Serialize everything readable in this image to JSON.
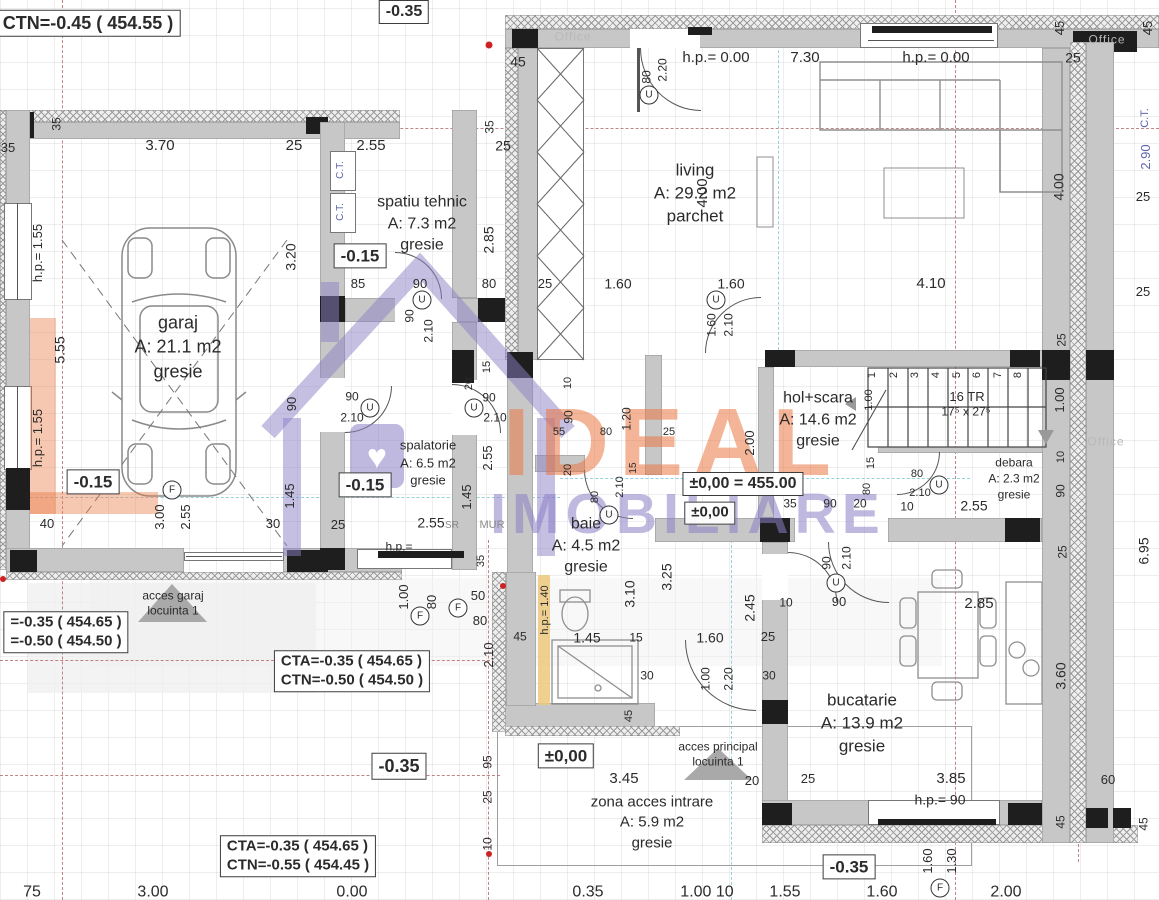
{
  "watermark": {
    "brand_top": "IDEAL",
    "brand_bottom": "IMOBILIARE",
    "office": "Office"
  },
  "colors": {
    "wall_gray": "#c7c7c7",
    "wall_dark": "#1e1e1e",
    "axis_red": "#b06868",
    "cyan": "#7ec4d4",
    "yellow": "#ecc87e",
    "blue_label": "#5f63ae",
    "brand_orange": "#ea7642",
    "brand_purple": "#8b80c6"
  },
  "levels": [
    {
      "lines": [
        "CTN=-0.45 ( 454.55 )"
      ],
      "x": 88,
      "y": 23,
      "s": 18
    },
    {
      "lines": [
        "-0.35"
      ],
      "x": 404,
      "y": 12,
      "s": 16
    },
    {
      "lines": [
        "-0.15"
      ],
      "x": 360,
      "y": 256,
      "s": 17
    },
    {
      "lines": [
        "-0.15"
      ],
      "x": 93,
      "y": 482,
      "s": 17
    },
    {
      "lines": [
        "-0.15"
      ],
      "x": 365,
      "y": 485,
      "s": 17
    },
    {
      "lines": [
        "±0,00 = 455.00"
      ],
      "x": 743,
      "y": 484,
      "s": 16
    },
    {
      "lines": [
        "±0,00"
      ],
      "x": 710,
      "y": 513,
      "s": 15
    },
    {
      "lines": [
        "±0,00"
      ],
      "x": 566,
      "y": 756,
      "s": 17
    },
    {
      "lines": [
        "-0.35"
      ],
      "x": 399,
      "y": 766,
      "s": 18
    },
    {
      "lines": [
        "-0.35"
      ],
      "x": 849,
      "y": 867,
      "s": 17
    },
    {
      "lines": [
        "=-0.35 ( 454.65 )",
        "=-0.50 ( 454.50 )"
      ],
      "x": 66,
      "y": 632,
      "s": 15
    },
    {
      "lines": [
        "CTA=-0.35 ( 454.65 )",
        "CTN=-0.50 ( 454.50 )"
      ],
      "x": 352,
      "y": 671,
      "s": 15
    },
    {
      "lines": [
        "CTA=-0.35 ( 454.65 )",
        "CTN=-0.55 ( 454.45 )"
      ],
      "x": 298,
      "y": 856,
      "s": 15
    }
  ],
  "rooms": [
    {
      "lines": [
        "garaj",
        "A: 21.1 m2",
        "gresie"
      ],
      "x": 178,
      "y": 347,
      "s": 18
    },
    {
      "lines": [
        "spatiu tehnic",
        "A: 7.3 m2",
        "gresie"
      ],
      "x": 422,
      "y": 224,
      "s": 16
    },
    {
      "lines": [
        "living",
        "A: 29.2 m2",
        "parchet"
      ],
      "x": 695,
      "y": 194,
      "s": 17
    },
    {
      "lines": [
        "spalatorie",
        "A: 6.5 m2",
        "gresie"
      ],
      "x": 428,
      "y": 463,
      "s": 13
    },
    {
      "lines": [
        "hol+scara",
        "A: 14.6 m2",
        "gresie"
      ],
      "x": 818,
      "y": 420,
      "s": 16
    },
    {
      "lines": [
        "debara",
        "A: 2.3 m2",
        "gresie"
      ],
      "x": 1014,
      "y": 479,
      "s": 12
    },
    {
      "lines": [
        "baie",
        "A: 4.5 m2",
        "gresie"
      ],
      "x": 586,
      "y": 546,
      "s": 16
    },
    {
      "lines": [
        "bucatarie",
        "A: 13.9 m2",
        "gresie"
      ],
      "x": 862,
      "y": 724,
      "s": 17
    },
    {
      "lines": [
        "zona acces intrare",
        "A: 5.9 m2",
        "gresie"
      ],
      "x": 652,
      "y": 823,
      "s": 15
    }
  ],
  "labels": [
    {
      "t": "35",
      "x": 8,
      "y": 148,
      "s": 13
    },
    {
      "t": "3.70",
      "x": 160,
      "y": 146,
      "s": 15
    },
    {
      "t": "25",
      "x": 294,
      "y": 146,
      "s": 15
    },
    {
      "t": "2.55",
      "x": 371,
      "y": 146,
      "s": 15
    },
    {
      "t": "25",
      "x": 503,
      "y": 146,
      "s": 14
    },
    {
      "t": "35",
      "x": 57,
      "y": 124,
      "r": 1,
      "s": 12
    },
    {
      "t": "35",
      "x": 490,
      "y": 127,
      "r": 1,
      "s": 12
    },
    {
      "t": "45",
      "x": 518,
      "y": 62,
      "s": 14
    },
    {
      "t": "80",
      "x": 647,
      "y": 77,
      "r": 1,
      "s": 12
    },
    {
      "t": "2.20",
      "x": 663,
      "y": 70,
      "r": 1,
      "s": 12
    },
    {
      "t": "h.p.= 0.00",
      "x": 716,
      "y": 58,
      "s": 15
    },
    {
      "t": "7.30",
      "x": 805,
      "y": 58,
      "s": 15
    },
    {
      "t": "h.p.= 0.00",
      "x": 936,
      "y": 58,
      "s": 15
    },
    {
      "t": "25",
      "x": 1073,
      "y": 58,
      "s": 14
    },
    {
      "t": "45",
      "x": 1060,
      "y": 28,
      "r": 1,
      "s": 13
    },
    {
      "t": "45",
      "x": 1148,
      "y": 28,
      "r": 1,
      "s": 13
    },
    {
      "t": "C.T.",
      "x": 1146,
      "y": 118,
      "r": 1,
      "c": "blue",
      "s": 11
    },
    {
      "t": "2.90",
      "x": 1146,
      "y": 157,
      "r": 1,
      "c": "blue",
      "s": 13
    },
    {
      "t": "25",
      "x": 1143,
      "y": 197,
      "s": 13
    },
    {
      "t": "4.00",
      "x": 1059,
      "y": 187,
      "r": 1,
      "s": 14
    },
    {
      "t": "25",
      "x": 1143,
      "y": 292,
      "s": 13
    },
    {
      "t": "4.00",
      "x": 703,
      "y": 193,
      "r": 1,
      "s": 15
    },
    {
      "t": "2.85",
      "x": 489,
      "y": 240,
      "r": 1,
      "s": 14
    },
    {
      "t": "3.20",
      "x": 291,
      "y": 257,
      "r": 1,
      "s": 14
    },
    {
      "t": "C.T.",
      "x": 341,
      "y": 170,
      "r": 1,
      "c": "blue",
      "s": 10
    },
    {
      "t": "C.T.",
      "x": 341,
      "y": 212,
      "r": 1,
      "c": "blue",
      "s": 10
    },
    {
      "t": "85",
      "x": 358,
      "y": 284,
      "s": 13
    },
    {
      "t": "90",
      "x": 420,
      "y": 284,
      "s": 13
    },
    {
      "t": "80",
      "x": 489,
      "y": 284,
      "s": 13
    },
    {
      "t": "25",
      "x": 545,
      "y": 284,
      "s": 13
    },
    {
      "t": "1.60",
      "x": 618,
      "y": 284,
      "s": 14
    },
    {
      "t": "1.60",
      "x": 731,
      "y": 284,
      "s": 14
    },
    {
      "t": "4.10",
      "x": 931,
      "y": 284,
      "s": 15
    },
    {
      "t": "90",
      "x": 410,
      "y": 316,
      "r": 1,
      "s": 12
    },
    {
      "t": "2.10",
      "x": 429,
      "y": 331,
      "r": 1,
      "s": 12
    },
    {
      "t": "h.p.= 1.55",
      "x": 38,
      "y": 253,
      "r": 1,
      "s": 13
    },
    {
      "t": "5.55",
      "x": 60,
      "y": 350,
      "r": 1,
      "s": 14
    },
    {
      "t": "h.p.= 1.55",
      "x": 38,
      "y": 438,
      "r": 1,
      "s": 13
    },
    {
      "t": "90",
      "x": 292,
      "y": 404,
      "r": 1,
      "s": 13
    },
    {
      "t": "1.45",
      "x": 290,
      "y": 496,
      "r": 1,
      "s": 13
    },
    {
      "t": "90",
      "x": 352,
      "y": 397,
      "s": 12
    },
    {
      "t": "2.10",
      "x": 352,
      "y": 418,
      "s": 12
    },
    {
      "t": "90",
      "x": 489,
      "y": 398,
      "s": 12
    },
    {
      "t": "2.10",
      "x": 495,
      "y": 418,
      "s": 12
    },
    {
      "t": "20",
      "x": 470,
      "y": 384,
      "r": 1,
      "s": 11
    },
    {
      "t": "15",
      "x": 488,
      "y": 367,
      "r": 1,
      "s": 11
    },
    {
      "t": "2.55",
      "x": 488,
      "y": 458,
      "r": 1,
      "s": 13
    },
    {
      "t": "1.45",
      "x": 467,
      "y": 497,
      "r": 1,
      "s": 13
    },
    {
      "t": "40",
      "x": 47,
      "y": 524,
      "s": 13
    },
    {
      "t": "3.00",
      "x": 160,
      "y": 517,
      "r": 1,
      "s": 13
    },
    {
      "t": "2.55",
      "x": 186,
      "y": 517,
      "r": 1,
      "s": 13
    },
    {
      "t": "30",
      "x": 273,
      "y": 524,
      "s": 13
    },
    {
      "t": "25",
      "x": 338,
      "y": 525,
      "s": 13
    },
    {
      "t": "2.55",
      "x": 431,
      "y": 523,
      "s": 14
    },
    {
      "t": "SR",
      "x": 452,
      "y": 526,
      "s": 10,
      "c": "gray"
    },
    {
      "t": "MUR",
      "x": 492,
      "y": 526,
      "s": 11,
      "c": "gray"
    },
    {
      "t": "h.p.=",
      "x": 399,
      "y": 547,
      "s": 12
    },
    {
      "t": "10",
      "x": 569,
      "y": 383,
      "r": 1,
      "s": 11
    },
    {
      "t": "90",
      "x": 569,
      "y": 417,
      "r": 1,
      "s": 12
    },
    {
      "t": "55",
      "x": 559,
      "y": 433,
      "s": 11
    },
    {
      "t": "80",
      "x": 606,
      "y": 433,
      "s": 11
    },
    {
      "t": "1.20",
      "x": 627,
      "y": 419,
      "r": 1,
      "s": 12
    },
    {
      "t": "25",
      "x": 669,
      "y": 433,
      "s": 11
    },
    {
      "t": "2.00",
      "x": 750,
      "y": 443,
      "r": 1,
      "s": 13
    },
    {
      "t": "20",
      "x": 569,
      "y": 470,
      "r": 1,
      "s": 11
    },
    {
      "t": "1.60",
      "x": 712,
      "y": 325,
      "r": 1,
      "s": 12
    },
    {
      "t": "2.10",
      "x": 729,
      "y": 325,
      "r": 1,
      "s": 12
    },
    {
      "t": "35",
      "x": 790,
      "y": 504,
      "s": 12
    },
    {
      "t": "90",
      "x": 830,
      "y": 504,
      "s": 12
    },
    {
      "t": "20",
      "x": 860,
      "y": 504,
      "s": 12
    },
    {
      "t": "10",
      "x": 907,
      "y": 507,
      "s": 12
    },
    {
      "t": "2.55",
      "x": 974,
      "y": 506,
      "s": 14
    },
    {
      "t": "80",
      "x": 917,
      "y": 475,
      "s": 11
    },
    {
      "t": "2.10",
      "x": 920,
      "y": 494,
      "s": 11
    },
    {
      "t": "15",
      "x": 872,
      "y": 463,
      "r": 1,
      "s": 11
    },
    {
      "t": "80",
      "x": 868,
      "y": 489,
      "r": 1,
      "s": 11
    },
    {
      "t": "90",
      "x": 827,
      "y": 563,
      "r": 1,
      "s": 12
    },
    {
      "t": "2.10",
      "x": 847,
      "y": 558,
      "r": 1,
      "s": 12
    },
    {
      "t": "80",
      "x": 596,
      "y": 497,
      "r": 1,
      "s": 11
    },
    {
      "t": "2.10",
      "x": 621,
      "y": 487,
      "r": 1,
      "s": 11
    },
    {
      "t": "15",
      "x": 634,
      "y": 468,
      "r": 1,
      "s": 10
    },
    {
      "t": "3.10",
      "x": 630,
      "y": 594,
      "r": 1,
      "s": 14
    },
    {
      "t": "3.25",
      "x": 667,
      "y": 577,
      "r": 1,
      "s": 14
    },
    {
      "t": "2.45",
      "x": 750,
      "y": 608,
      "r": 1,
      "s": 14
    },
    {
      "t": "1.45",
      "x": 587,
      "y": 638,
      "s": 14
    },
    {
      "t": "15",
      "x": 636,
      "y": 638,
      "s": 12
    },
    {
      "t": "30",
      "x": 647,
      "y": 676,
      "s": 12
    },
    {
      "t": "45",
      "x": 520,
      "y": 637,
      "s": 12
    },
    {
      "t": "50",
      "x": 478,
      "y": 596,
      "s": 13
    },
    {
      "t": "80",
      "x": 480,
      "y": 621,
      "s": 13
    },
    {
      "t": "2.10",
      "x": 489,
      "y": 655,
      "r": 1,
      "s": 13
    },
    {
      "t": "1.00",
      "x": 404,
      "y": 597,
      "r": 1,
      "s": 13
    },
    {
      "t": "80",
      "x": 432,
      "y": 602,
      "r": 1,
      "s": 13
    },
    {
      "t": "35",
      "x": 482,
      "y": 561,
      "r": 1,
      "s": 11
    },
    {
      "t": "h.p.= 1.40",
      "x": 546,
      "y": 610,
      "r": 1,
      "s": 11
    },
    {
      "t": "1.60",
      "x": 710,
      "y": 638,
      "s": 14
    },
    {
      "t": "25",
      "x": 768,
      "y": 637,
      "s": 13
    },
    {
      "t": "10",
      "x": 786,
      "y": 603,
      "s": 12
    },
    {
      "t": "30",
      "x": 769,
      "y": 676,
      "s": 12
    },
    {
      "t": "1.00",
      "x": 706,
      "y": 679,
      "r": 1,
      "s": 12
    },
    {
      "t": "2.20",
      "x": 729,
      "y": 679,
      "r": 1,
      "s": 12
    },
    {
      "t": "45",
      "x": 630,
      "y": 716,
      "r": 1,
      "s": 11
    },
    {
      "t": "95",
      "x": 488,
      "y": 762,
      "r": 1,
      "s": 12
    },
    {
      "t": "25",
      "x": 488,
      "y": 797,
      "r": 1,
      "s": 12
    },
    {
      "t": "10",
      "x": 488,
      "y": 844,
      "r": 1,
      "s": 12
    },
    {
      "t": "3.45",
      "x": 624,
      "y": 779,
      "s": 15
    },
    {
      "t": "20",
      "x": 752,
      "y": 781,
      "s": 13
    },
    {
      "t": "90",
      "x": 839,
      "y": 602,
      "s": 13
    },
    {
      "t": "2.85",
      "x": 979,
      "y": 604,
      "s": 15
    },
    {
      "t": "3.60",
      "x": 1061,
      "y": 676,
      "r": 1,
      "s": 14
    },
    {
      "t": "25",
      "x": 808,
      "y": 779,
      "s": 13
    },
    {
      "t": "3.85",
      "x": 951,
      "y": 779,
      "s": 15
    },
    {
      "t": "h.p.= 90",
      "x": 940,
      "y": 800,
      "s": 14
    },
    {
      "t": "60",
      "x": 1108,
      "y": 780,
      "s": 13
    },
    {
      "t": "45",
      "x": 1061,
      "y": 822,
      "r": 1,
      "s": 12
    },
    {
      "t": "45",
      "x": 1144,
      "y": 824,
      "r": 1,
      "s": 12
    },
    {
      "t": "1.60",
      "x": 928,
      "y": 861,
      "r": 1,
      "s": 13
    },
    {
      "t": "1.30",
      "x": 952,
      "y": 861,
      "r": 1,
      "s": 13
    },
    {
      "t": "6.95",
      "x": 1144,
      "y": 551,
      "r": 1,
      "s": 14
    },
    {
      "t": "25",
      "x": 1062,
      "y": 340,
      "r": 1,
      "s": 12
    },
    {
      "t": "1.00",
      "x": 1060,
      "y": 400,
      "r": 1,
      "s": 13
    },
    {
      "t": "10",
      "x": 1062,
      "y": 457,
      "r": 1,
      "s": 11
    },
    {
      "t": "90",
      "x": 1061,
      "y": 491,
      "r": 1,
      "s": 12
    },
    {
      "t": "25",
      "x": 1063,
      "y": 552,
      "r": 1,
      "s": 12
    },
    {
      "t": "16 TR",
      "x": 967,
      "y": 397,
      "s": 13
    },
    {
      "t": "17⁵ x 27⁵",
      "x": 966,
      "y": 412,
      "s": 12
    },
    {
      "t": "1",
      "x": 873,
      "y": 375,
      "r": 1,
      "s": 11
    },
    {
      "t": "2",
      "x": 895,
      "y": 375,
      "r": 1,
      "s": 11
    },
    {
      "t": "3",
      "x": 916,
      "y": 375,
      "r": 1,
      "s": 11
    },
    {
      "t": "4",
      "x": 937,
      "y": 375,
      "r": 1,
      "s": 11
    },
    {
      "t": "5",
      "x": 958,
      "y": 375,
      "r": 1,
      "s": 11
    },
    {
      "t": "6",
      "x": 978,
      "y": 375,
      "r": 1,
      "s": 11
    },
    {
      "t": "7",
      "x": 999,
      "y": 375,
      "r": 1,
      "s": 11
    },
    {
      "t": "8",
      "x": 1019,
      "y": 375,
      "r": 1,
      "s": 11
    },
    {
      "t": "1.00",
      "x": 870,
      "y": 400,
      "r": 1,
      "s": 11
    },
    {
      "t": "acces garaj",
      "x": 173,
      "y": 596,
      "s": 12
    },
    {
      "t": "locuinta 1",
      "x": 173,
      "y": 611,
      "s": 12
    },
    {
      "t": "acces principal",
      "x": 718,
      "y": 747,
      "s": 12
    },
    {
      "t": "locuinta 1",
      "x": 718,
      "y": 762,
      "s": 12
    },
    {
      "t": "Office",
      "x": 573,
      "y": 37,
      "c": "wm"
    },
    {
      "t": "Office",
      "x": 1107,
      "y": 40,
      "c": "wm"
    },
    {
      "t": "Office",
      "x": 1106,
      "y": 442,
      "c": "wm"
    },
    {
      "t": "75",
      "x": 32,
      "y": 893,
      "s": 16
    },
    {
      "t": "3.00",
      "x": 153,
      "y": 893,
      "s": 16
    },
    {
      "t": "0.00",
      "x": 352,
      "y": 893,
      "s": 16
    },
    {
      "t": "0.35",
      "x": 588,
      "y": 893,
      "s": 16
    },
    {
      "t": "1.00 10",
      "x": 707,
      "y": 893,
      "s": 16
    },
    {
      "t": "1.55",
      "x": 785,
      "y": 893,
      "s": 16
    },
    {
      "t": "1.60",
      "x": 882,
      "y": 893,
      "s": 16
    },
    {
      "t": "2.00",
      "x": 1006,
      "y": 893,
      "s": 16
    }
  ],
  "tags": [
    {
      "k": "U",
      "x": 370,
      "y": 408
    },
    {
      "k": "U",
      "x": 474,
      "y": 408
    },
    {
      "k": "U",
      "x": 422,
      "y": 300
    },
    {
      "k": "U",
      "x": 609,
      "y": 515
    },
    {
      "k": "U",
      "x": 836,
      "y": 583
    },
    {
      "k": "U",
      "x": 939,
      "y": 485
    },
    {
      "k": "U",
      "x": 716,
      "y": 300
    },
    {
      "k": "U",
      "x": 649,
      "y": 95
    },
    {
      "k": "F",
      "x": 172,
      "y": 490
    },
    {
      "k": "F",
      "x": 458,
      "y": 608
    },
    {
      "k": "F",
      "x": 420,
      "y": 616
    },
    {
      "k": "F",
      "x": 940,
      "y": 888
    }
  ]
}
